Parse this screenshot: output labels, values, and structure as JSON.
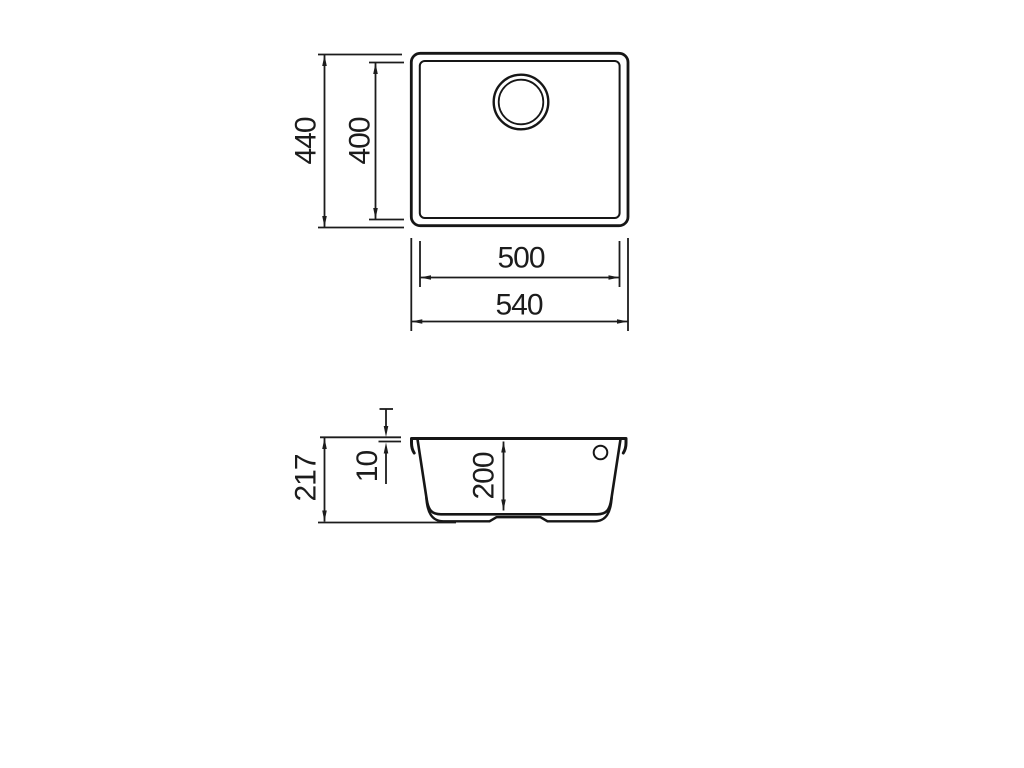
{
  "drawing": {
    "type": "sink-dimension-drawing",
    "background_color": "#ffffff",
    "line_color": "#1c1c1c",
    "text_color": "#1c1c1c",
    "views": {
      "top": {
        "dims": {
          "outer_height": "440",
          "inner_height": "400",
          "inner_width": "500",
          "outer_width": "540"
        }
      },
      "section": {
        "dims": {
          "total_height": "217",
          "rim_thickness": "10",
          "bowl_depth": "200"
        }
      }
    }
  }
}
